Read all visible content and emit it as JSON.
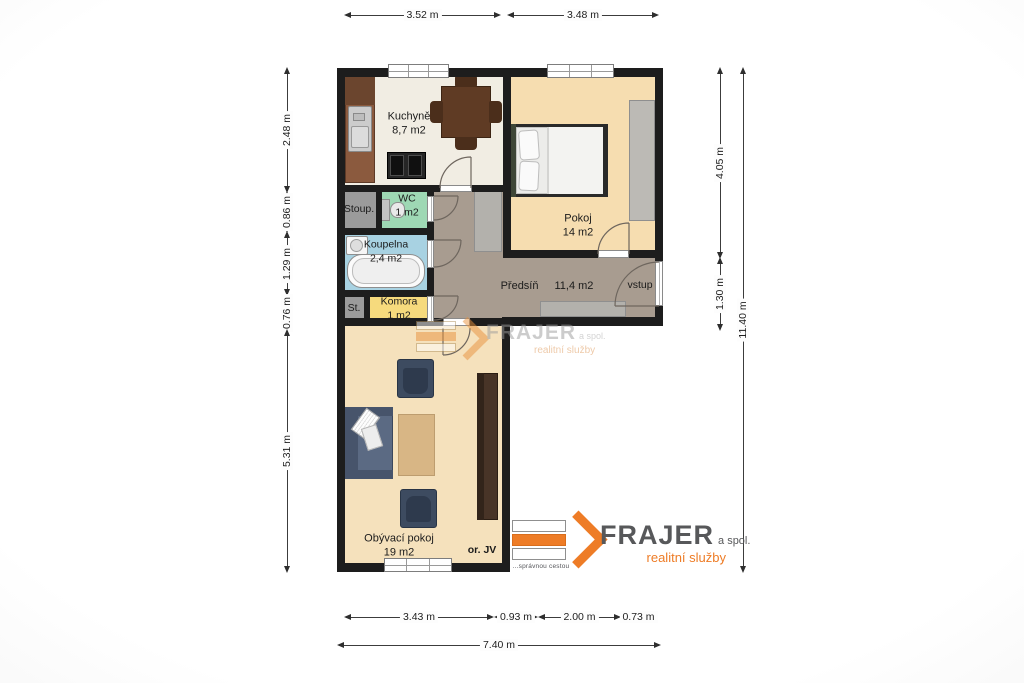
{
  "rooms": {
    "kuchyne": {
      "name": "Kuchyně",
      "area": "8,7 m2"
    },
    "pokoj": {
      "name": "Pokoj",
      "area": "14 m2"
    },
    "stoup": {
      "name": "Stoup."
    },
    "wc": {
      "name": "WC",
      "area": "1 m2"
    },
    "koupelna": {
      "name": "Koupelna",
      "area": "2,4 m2"
    },
    "st": {
      "name": "St."
    },
    "komora": {
      "name": "Komora",
      "area": "1 m2"
    },
    "predsin": {
      "name": "Předsíň",
      "area": "11,4 m2"
    },
    "vstup": {
      "name": "vstup"
    },
    "obyvaci": {
      "name": "Obývací pokoj",
      "area": "19 m2",
      "orientation": "or. JV"
    }
  },
  "dimensions": {
    "top": [
      "3.52 m",
      "3.48 m"
    ],
    "left": [
      "2.48 m",
      "0.86 m",
      "1.29 m",
      "0.76 m",
      "5.31 m"
    ],
    "right": [
      "4.05 m",
      "1.30 m"
    ],
    "right_total": "11.40 m",
    "bottom": [
      "3.43 m",
      "0.93 m",
      "2.00 m",
      "0.73 m"
    ],
    "bottom_total": "7.40 m"
  },
  "branding": {
    "watermark": {
      "brand": "FRAJER",
      "suffix": "a spol.",
      "tagline": "realitní služby"
    },
    "logo": {
      "brand": "FRAJER",
      "suffix": "a spol.",
      "tagline": "realitní služby",
      "slogan": "...správnou cestou"
    }
  },
  "colors": {
    "wall": "#1d1d1d",
    "kitchen_floor": "#f1ede3",
    "room_tan": "#f6ddb0",
    "living_tan": "#f5e1bc",
    "hall_floor": "#a89c90",
    "wc_green": "#9ed8b4",
    "bath_blue": "#a8d2e2",
    "komora_yellow": "#f6da7d",
    "utility_gray": "#9b9b9b",
    "brand_orange": "#ee7c26",
    "brand_gray": "#58595b"
  }
}
